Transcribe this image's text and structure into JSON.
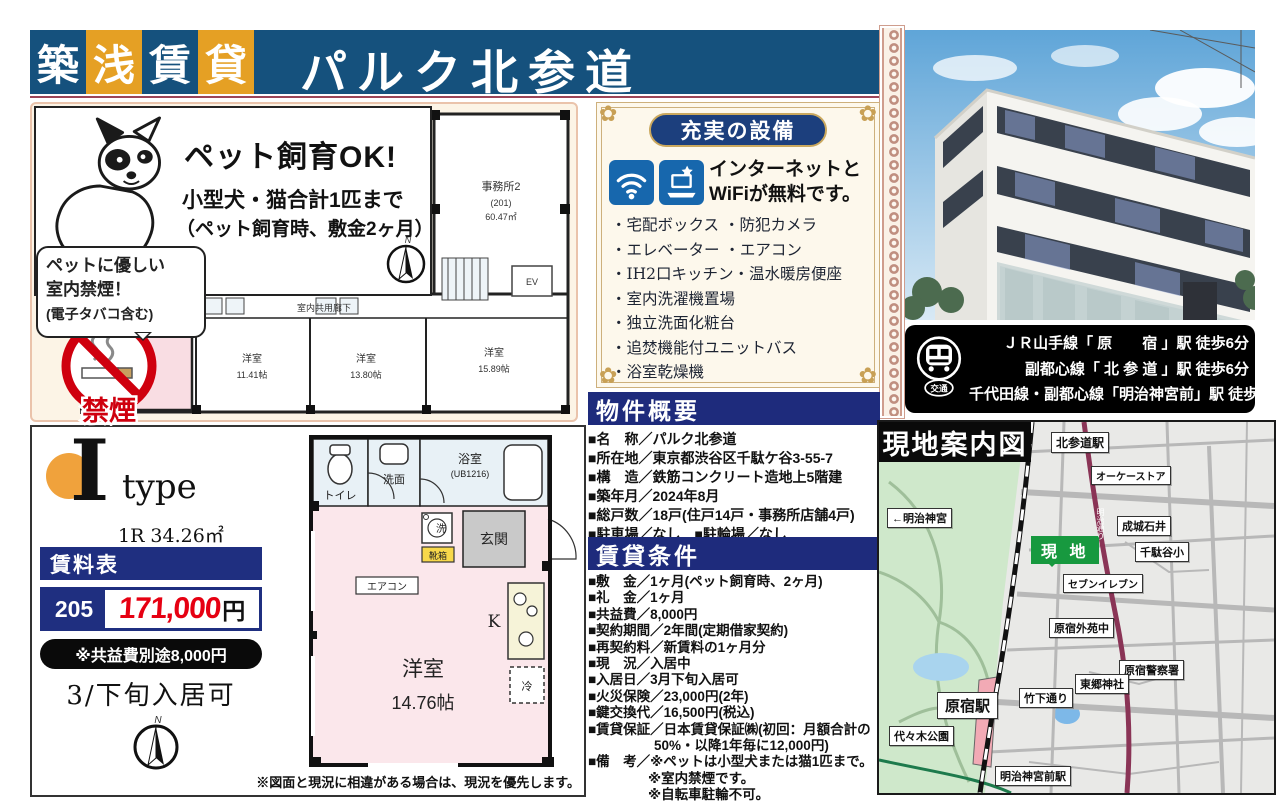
{
  "colors": {
    "header_blue": "#15517d",
    "header_gold": "#e5a024",
    "section_navy": "#1e2b7c",
    "price_red": "#e60012",
    "site_green": "#17993f",
    "panel_cream": "#fcf4e6",
    "room_pink": "#fbe7eb",
    "map_park_green": "#cfe8cb",
    "map_road_maroon": "#8a3456"
  },
  "header": {
    "chars": [
      "築",
      "浅",
      "賃",
      "貸"
    ],
    "title": "パルク北参道"
  },
  "pet": {
    "headline": "ペット飼育OK!",
    "sub1": "小型犬・猫合計1匹まで",
    "sub2": "（ペット飼育時、敷金2ヶ月）",
    "bubble1": "ペットに優しい",
    "bubble2": "室内禁煙！",
    "bubble3": "(電子タバコ含む)",
    "no_smoking": "禁煙"
  },
  "floor_plan": {
    "office_name": "事務所2",
    "office_no": "(201)",
    "office_area": "60.47㎡",
    "corridor": "室内共用廊下",
    "ev": "EV",
    "units": [
      {
        "name": "洋室",
        "size": "14.76帖"
      },
      {
        "name": "洋室",
        "size": "11.41帖"
      },
      {
        "name": "洋室",
        "size": "13.80帖"
      },
      {
        "name": "洋室",
        "size": "15.89帖"
      }
    ]
  },
  "equipment": {
    "badge": "充実の設備",
    "free1": "インターネットと",
    "free2": "WiFiが無料です。",
    "items": [
      "・宅配ボックス ・防犯カメラ",
      "・エレベーター ・エアコン",
      "・IH2口キッチン・温水暖房便座",
      "・室内洗濯機置場",
      "・独立洗面化粧台",
      "・追焚機能付ユニットバス",
      "・浴室乾燥機"
    ]
  },
  "transport": {
    "icon": "交通",
    "lines": [
      "ＪＲ山手線「 原　　宿 」駅 徒歩6分",
      "副都心線「 北 参 道 」駅 徒歩6分",
      "千代田線・副都心線「明治神宮前」駅 徒歩9分"
    ]
  },
  "overview": {
    "title": "物件概要",
    "lines": [
      "■名　称／パルク北参道",
      "■所在地／東京都渋谷区千駄ケ谷3-55-7",
      "■構　造／鉄筋コンクリート造地上5階建",
      "■築年月／2024年8月",
      "■総戸数／18戸(住戸14戸・事務所店舗4戸)",
      "■駐車場／なし　■駐輪場／なし"
    ]
  },
  "conditions": {
    "title": "賃貸条件",
    "lines": [
      "■敷　金／1ヶ月(ペット飼育時、2ヶ月)",
      "■礼　金／1ヶ月",
      "■共益費／8,000円",
      "■契約期間／2年間(定期借家契約)",
      "■再契約料／新賃料の1ヶ月分",
      "■現　況／入居中",
      "■入居日／3月下旬入居可",
      "■火災保険／23,000円(2年)",
      "■鍵交換代／16,500円(税込)",
      "■賃貸保証／日本賃貸保証㈱(初回：月額合計の",
      "50%・以降1年毎に12,000円)",
      "■備　考／※ペットは小型犬または猫1匹まで。",
      "※室内禁煙です。",
      "※自転車駐輪不可。"
    ]
  },
  "unit": {
    "type_letter": "I",
    "type_word": "type",
    "spec": "1R  34.26㎡",
    "rent_title": "賃料表",
    "room": "205",
    "price": "171,000",
    "yen": "円",
    "fee_note": "※共益費別途8,000円",
    "move_in": "3/下旬入居可",
    "compass_n": "N",
    "note": "※図面と現況に相違がある場合は、現況を優先します。",
    "plan": {
      "toilet": "トイレ",
      "wash": "洗面",
      "bath": "浴室",
      "bath_ub": "(UB1216)",
      "entrance": "玄関",
      "washer": "洗",
      "shoe": "靴箱",
      "ac": "エアコン",
      "k": "K",
      "fridge": "冷",
      "room": "洋室",
      "size": "14.76帖"
    }
  },
  "map": {
    "title": "現地案内図",
    "site": "現 地",
    "labels": {
      "kitasando": "北参道駅",
      "ok_store": "オーケーストア",
      "meiji_jingu": "←明治神宮",
      "seijo_ishii": "成城石井",
      "sendagaya_sho": "千駄谷小",
      "seven_eleven": "セブンイレブン",
      "gaien_chu": "原宿外苑中",
      "togo_jinja": "東郷神社",
      "police": "原宿警察署",
      "takeshita": "竹下通り",
      "harajuku": "原宿駅",
      "yoyogi_park": "代々木公園",
      "meiji_jingumae": "明治神宮前駅",
      "meiji_dori": "明治通り"
    }
  }
}
